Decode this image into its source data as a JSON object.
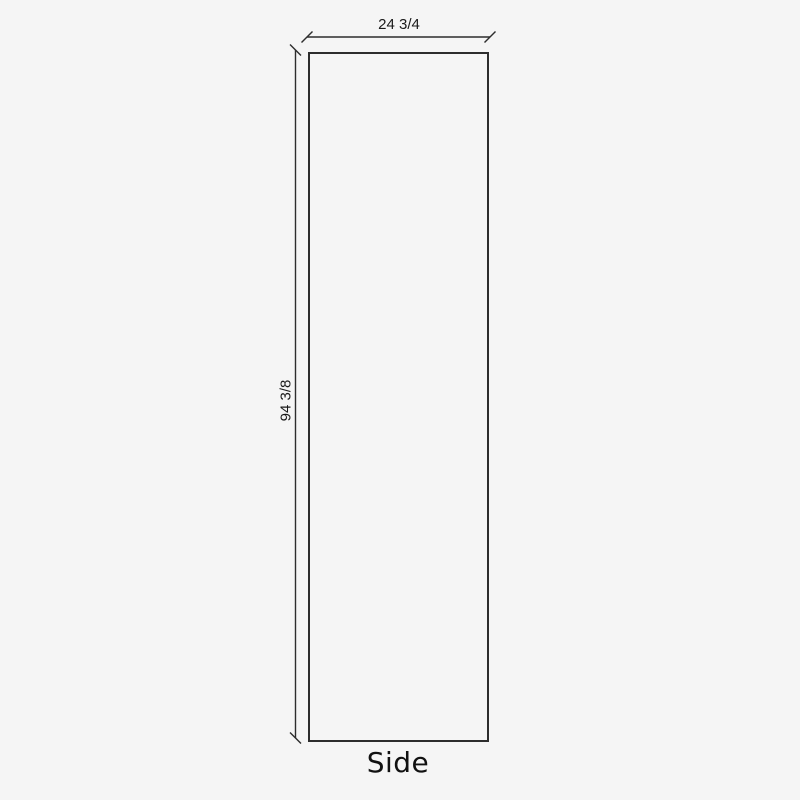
{
  "diagram": {
    "part_label": "Side",
    "width_dimension": "24 3/4",
    "height_dimension": "94 3/8"
  },
  "colors": {
    "background": "#f5f5f5",
    "line": "#2d2d2d",
    "text": "#1a1a1a"
  }
}
